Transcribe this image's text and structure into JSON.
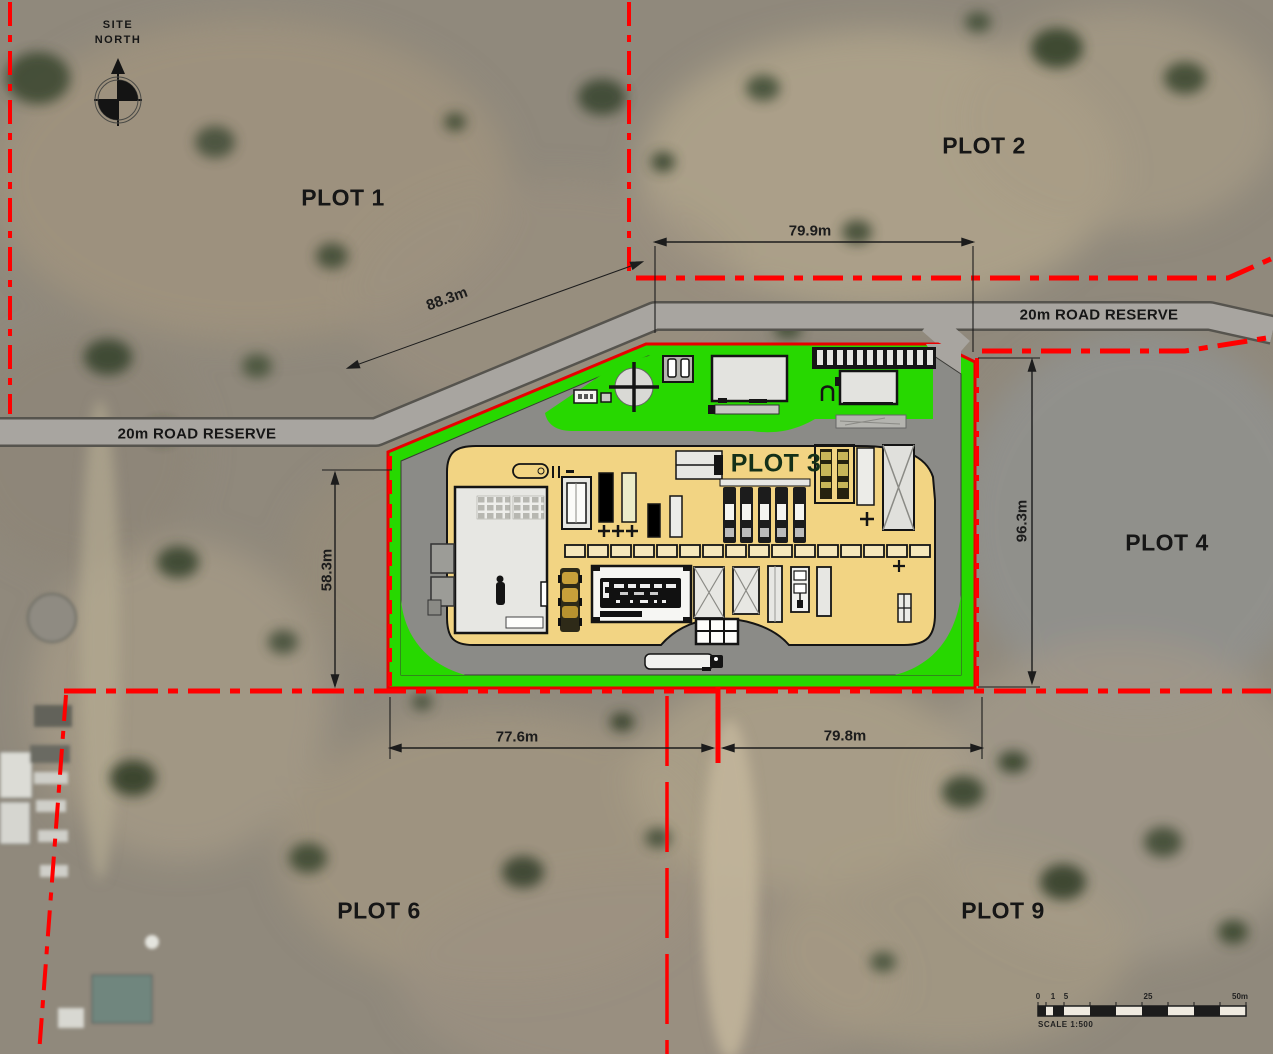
{
  "page": {
    "title": "Site Layout Plan over Aerial Photo"
  },
  "compass": {
    "line1": "SITE",
    "line2": "NORTH"
  },
  "plots": {
    "plot1": "PLOT 1",
    "plot2": "PLOT 2",
    "plot3": "PLOT 3",
    "plot4": "PLOT 4",
    "plot6": "PLOT 6",
    "plot9": "PLOT 9"
  },
  "roads": {
    "left_label": "20m ROAD RESERVE",
    "right_label": "20m ROAD RESERVE"
  },
  "dimensions": {
    "top_width": "79.9m",
    "northwest_diagonal": "88.3m",
    "east_depth": "96.3m",
    "west_depth": "58.3m",
    "bottom_west": "77.6m",
    "bottom_east": "79.8m"
  },
  "scale_bar": {
    "ticks": [
      "0",
      "1",
      "5",
      "25",
      "50m"
    ],
    "caption": "SCALE 1:500"
  },
  "colors": {
    "boundary_red": "#ff0000",
    "landscape_green": "#27d800",
    "hardstand_yellow": "#f2d483",
    "road_gray": "#a8a5a0",
    "ring_road_gray": "#8b8b87"
  }
}
